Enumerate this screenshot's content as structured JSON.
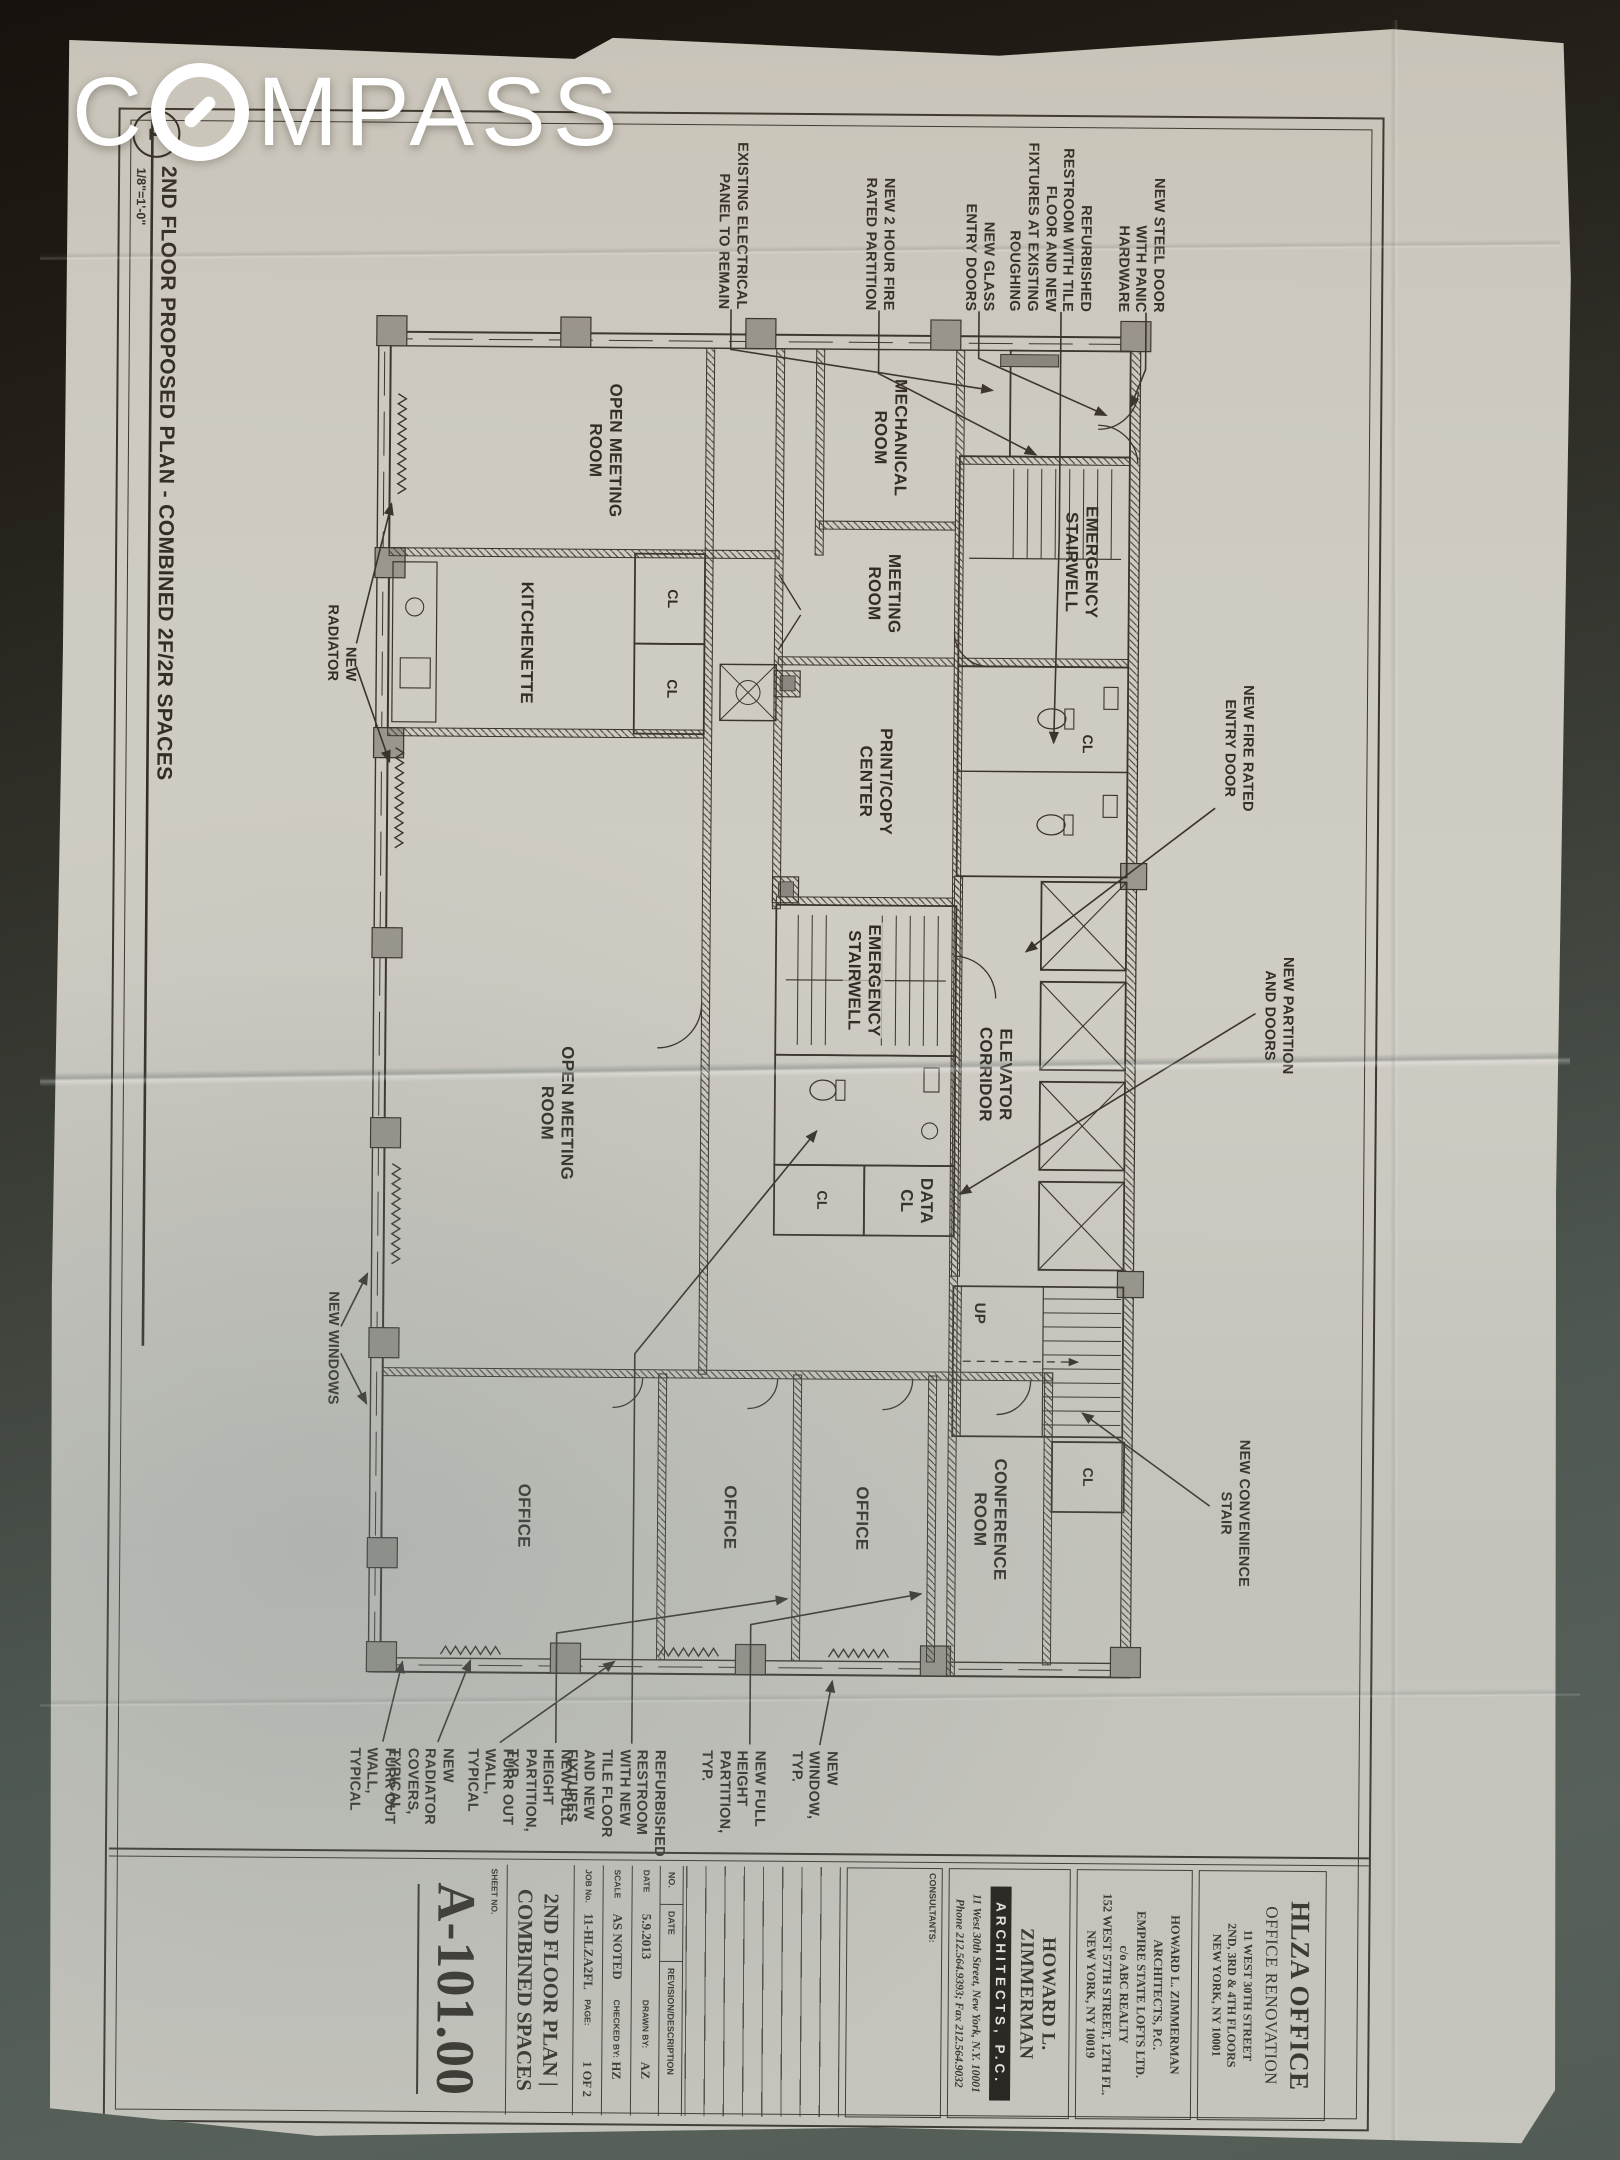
{
  "watermark": {
    "brand": "COMPASS",
    "brand_prefix": "C",
    "brand_suffix": "MPASS"
  },
  "drawing_title": {
    "detail_number": "1",
    "title": "2ND FLOOR PROPOSED PLAN - COMBINED 2F/2R SPACES",
    "scale": "1/8\"=1'-0\""
  },
  "plan": {
    "rooms": [
      {
        "label": "EMERGENCY\nSTAIRWELL"
      },
      {
        "label": "MECHANICAL\nROOM"
      },
      {
        "label": "MEETING\nROOM"
      },
      {
        "label": "PRINT/COPY\nCENTER"
      },
      {
        "label": "ELEVATOR\nCORRIDOR"
      },
      {
        "label": "EMERGENCY\nSTAIRWELL"
      },
      {
        "label": "DATA\nCL"
      },
      {
        "label": "OPEN MEETING\nROOM"
      },
      {
        "label": "KITCHENETTE"
      },
      {
        "label": "OPEN MEETING\nROOM"
      },
      {
        "label": "CONFERENCE\nROOM"
      },
      {
        "label": "OFFICE"
      },
      {
        "label": "OFFICE"
      },
      {
        "label": "OFFICE"
      }
    ],
    "closet_label": "CL",
    "up_label": "UP"
  },
  "annotations": {
    "left": [
      {
        "text": "NEW STEEL DOOR\nWITH PANIC\nHARDWARE"
      },
      {
        "text": "REFURBISHED\nRESTROOM WITH TILE\nFLOOR AND NEW\nFIXTURES AT EXISTING\nROUGHING"
      },
      {
        "text": "NEW GLASS\nENTRY DOORS"
      },
      {
        "text": "NEW 2 HOUR FIRE\nRATED PARTITION"
      },
      {
        "text": "EXISTING ELECTRICAL\nPANEL TO REMAIN"
      }
    ],
    "top": [
      {
        "text": "NEW FIRE RATED\nENTRY DOOR"
      },
      {
        "text": "NEW PARTITION\nAND DOORS"
      },
      {
        "text": "NEW CONVENIENCE\nSTAIR"
      }
    ],
    "right": [
      {
        "text": "NEW WINDOW,\nTYP."
      },
      {
        "text": "NEW FULL HEIGHT\nPARTITION, TYP."
      },
      {
        "text": "REFURBISHED\nRESTROOM WITH NEW\nTILE FLOOR AND NEW\nFIXTURES"
      },
      {
        "text": "NEW FULL HEIGHT\nPARTITION, TYP."
      },
      {
        "text": "FURR OUT WALL,\nTYPICAL"
      },
      {
        "text": "NEW RADIATOR\nCOVERS, TYPICAL"
      },
      {
        "text": "FURR OUT WALL,\nTYPICAL"
      }
    ],
    "bottom": [
      {
        "text": "NEW WINDOWS"
      },
      {
        "text": "NEW RADIATOR"
      }
    ]
  },
  "titleblock": {
    "project": {
      "name": "HLZA OFFICE",
      "subtitle": "OFFICE RENOVATION",
      "address": "11 WEST 30TH STREET\n2ND, 3RD & 4TH FLOORS\nNEW YORK, NY 10001"
    },
    "owner": "HOWARD L. ZIMMERMAN\nARCHITECTS, P.C.\nEMPIRE STATE LOFTS LTD.\nc/o ABC REALTY\n152 WEST 57TH STREET, 12TH FL.\nNEW YORK, NY 10019",
    "architect": {
      "name": "HOWARD L. ZIMMERMAN",
      "firm": "ARCHITECTS, P.C.",
      "address": "11 West 30th Street, New York, N.Y. 10001",
      "phone": "Phone 212.564.9393;  Fax 212.564.9032"
    },
    "consultants_label": "CONSULTANTS:",
    "revisions": {
      "no": "NO.",
      "date": "DATE",
      "description": "REVISION/DESCRIPTION"
    },
    "fields": [
      {
        "label": "DATE",
        "value": "5.9.2013",
        "label2": "DRAWN BY:",
        "value2": "AZ"
      },
      {
        "label": "SCALE",
        "value": "AS NOTED",
        "label2": "CHECKED BY:",
        "value2": "HZ"
      },
      {
        "label": "JOB No.",
        "value": "11-HLZA2FL",
        "label2": "PAGE:",
        "value2": "1 OF 2"
      }
    ],
    "sheet_no_label": "SHEET NO.",
    "sheet_number": "A-101.00",
    "sheet_title": "2ND FLOOR PLAN |\nCOMBINED SPACES"
  }
}
